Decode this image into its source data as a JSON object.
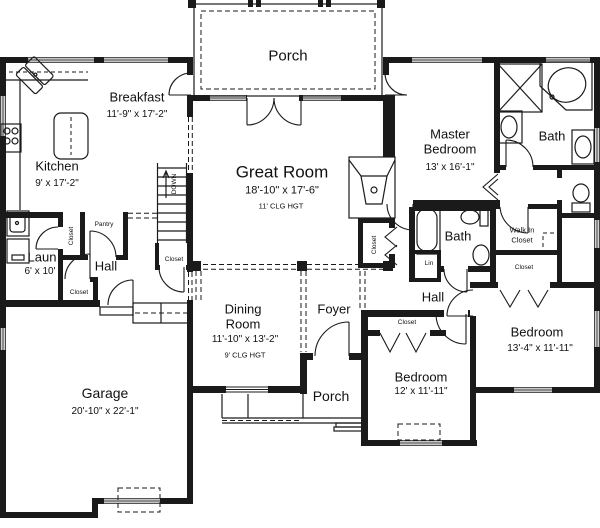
{
  "rooms": {
    "porch_top": {
      "label": "Porch"
    },
    "breakfast": {
      "label": "Breakfast",
      "dims": "11'-9\" x 17'-2\""
    },
    "kitchen": {
      "label": "Kitchen",
      "dims": "9' x 17'-2\""
    },
    "great_room": {
      "label": "Great Room",
      "dims": "18'-10\" x 17'-6\"",
      "ceiling": "11' CLG HGT"
    },
    "master_bedroom": {
      "label_line1": "Master",
      "label_line2": "Bedroom",
      "dims": "13' x 16'-1\""
    },
    "master_bath": {
      "label": "Bath"
    },
    "laundry": {
      "label": "Laun",
      "dims": "6' x 10'"
    },
    "hall_left": {
      "label": "Hall"
    },
    "dining_room": {
      "label_line1": "Dining",
      "label_line2": "Room",
      "dims": "11'-10\" x 13'-2\"",
      "ceiling": "9' CLG HGT"
    },
    "foyer": {
      "label": "Foyer"
    },
    "hall_bath": {
      "label": "Bath"
    },
    "hall_right": {
      "label": "Hall"
    },
    "walk_in_closet": {
      "label_line1": "Walk In",
      "label_line2": "Closet"
    },
    "bedroom_2": {
      "label": "Bedroom",
      "dims": "12' x 11'-11\""
    },
    "bedroom_3": {
      "label": "Bedroom",
      "dims": "13'-4\" x 11'-11\""
    },
    "garage": {
      "label": "Garage",
      "dims": "20'-10\" x 22'-1\""
    },
    "porch_bottom": {
      "label": "Porch"
    }
  },
  "annotations": {
    "stairs_direction": "DOWN",
    "pantry": "Pantry",
    "closet": "Closet",
    "linen": "Lin"
  },
  "colors": {
    "line": "#1a1a1a",
    "background": "#ffffff"
  }
}
